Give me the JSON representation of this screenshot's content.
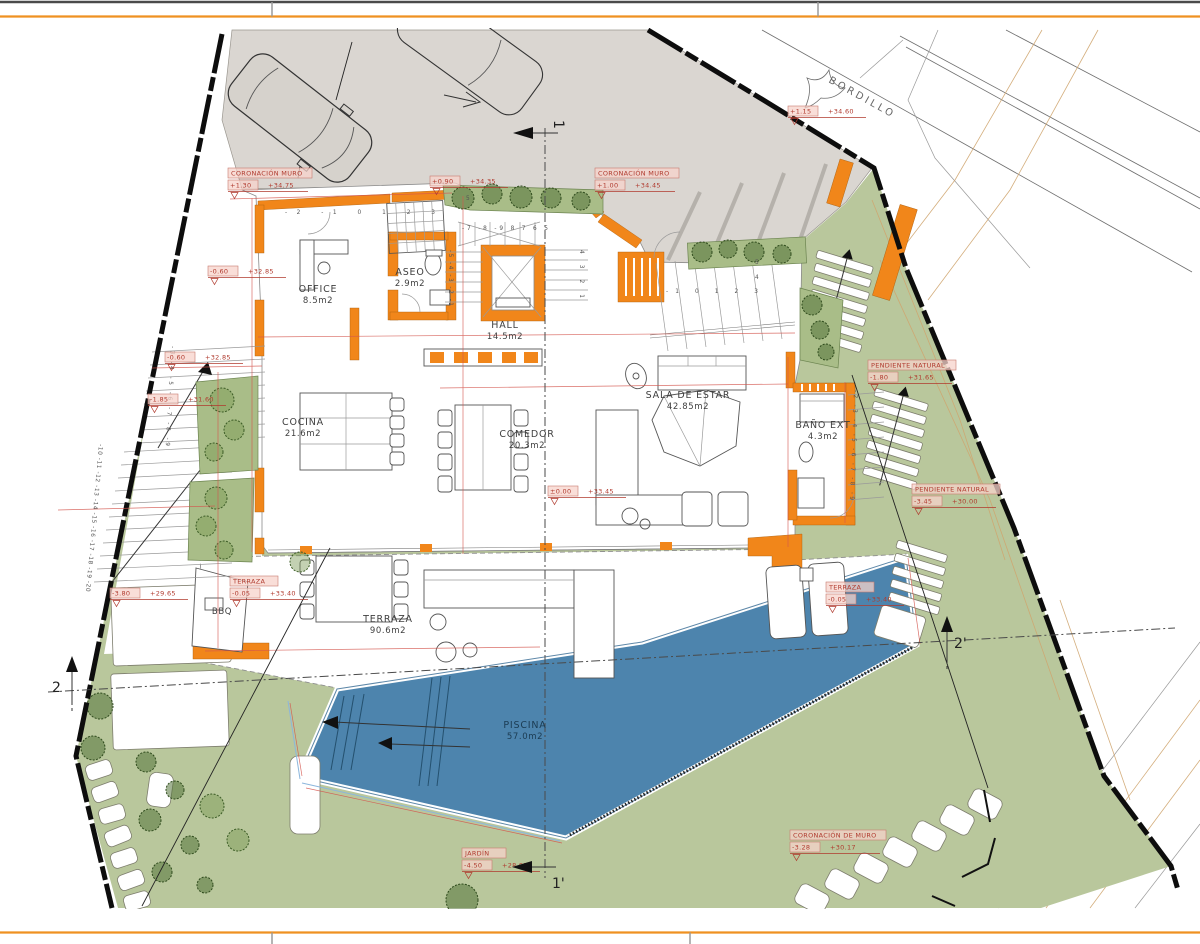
{
  "drawing": {
    "type": "site-floor-plan",
    "accent_wall_color": "#f1861a",
    "terrain_color": "#b9c79c",
    "pool_color": "#4d84ad",
    "road_color": "#dad6d1",
    "annotation_color": "#b03a2e"
  },
  "street": {
    "curb_label": "BORDILLO"
  },
  "rooms": [
    {
      "name": "OFFICE",
      "area": "8.5m2"
    },
    {
      "name": "ASEO",
      "area": "2.9m2"
    },
    {
      "name": "HALL",
      "area": "14.5m2"
    },
    {
      "name": "COCINA",
      "area": "21.6m2"
    },
    {
      "name": "COMEDOR",
      "area": "20.3m2"
    },
    {
      "name": "SALA DE ESTAR",
      "area": "42.85m2"
    },
    {
      "name": "BAÑO EXT",
      "area": "4.3m2"
    },
    {
      "name": "TERRAZA",
      "area": "90.6m2"
    },
    {
      "name": "PISCINA",
      "area": "57.0m2"
    },
    {
      "name": "BBQ",
      "area": ""
    }
  ],
  "levels": [
    {
      "title": "CORONACIÓN MURO",
      "rel": "+1.30",
      "abs": "+34.75"
    },
    {
      "title": "",
      "rel": "+0.90",
      "abs": "+34.35"
    },
    {
      "title": "CORONACIÓN MURO",
      "rel": "+1.00",
      "abs": "+34.45"
    },
    {
      "title": "",
      "rel": "+1.15",
      "abs": "+34.60"
    },
    {
      "title": "",
      "rel": "-0.60",
      "abs": "+32.85"
    },
    {
      "title": "",
      "rel": "-0.60",
      "abs": "+32.85"
    },
    {
      "title": "",
      "rel": "-1.85",
      "abs": "+31.60"
    },
    {
      "title": "",
      "rel": "-3.80",
      "abs": "+29.65"
    },
    {
      "title": "TERRAZA",
      "rel": "-0.05",
      "abs": "+33.40"
    },
    {
      "title": "",
      "rel": "±0.00",
      "abs": "+33.45"
    },
    {
      "title": "PENDIENTE NATURAL",
      "rel": "-1.80",
      "abs": "+31.65"
    },
    {
      "title": "PENDIENTE NATURAL",
      "rel": "-3.45",
      "abs": "+30.00"
    },
    {
      "title": "TERRAZA",
      "rel": "-0.05",
      "abs": "+33.40"
    },
    {
      "title": "JARDÍN",
      "rel": "-4.50",
      "abs": "+28.95"
    },
    {
      "title": "CORONACIÓN DE MURO",
      "rel": "-3.28",
      "abs": "+30.17"
    }
  ],
  "sections": {
    "top": "1",
    "bottom": "1'",
    "left": "2",
    "right": "2'"
  },
  "stairs": {
    "top_row": "-2   -1    0    1    2    3",
    "mid5": "5",
    "gate5": "5",
    "gate4": "4",
    "gate_row": "-1   0   1   2   3",
    "central_top": "-7 -8 -9   8  7  6  5",
    "central_left": "-5  -4  -3  -2  -1",
    "central_right": "4   3   2   1",
    "left_a": "-3  -4  -5  -6  -7  -8  -9",
    "left_b": "-10 -11 -12 -13 -14 -15 -16 -17 -18 -19 -20",
    "right_flight": "-2 -3 -4 -5 -6 -7 -8 -9"
  }
}
